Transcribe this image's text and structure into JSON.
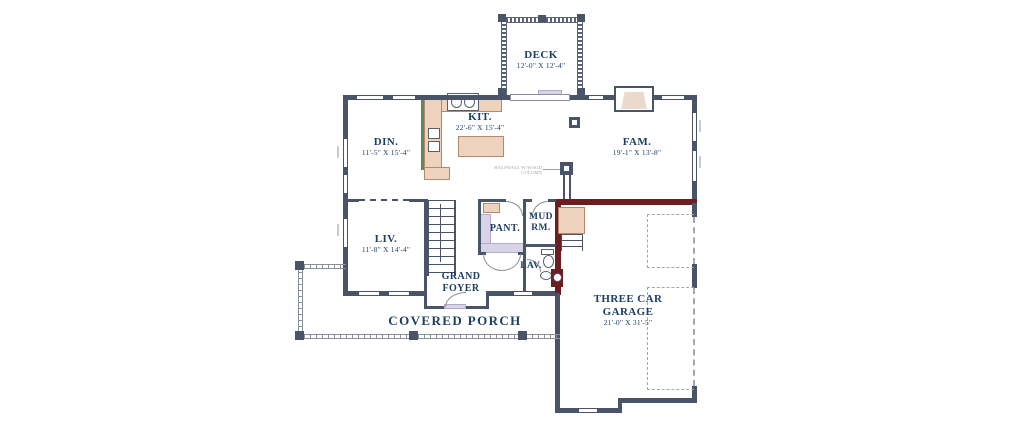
{
  "rooms": {
    "deck": {
      "label": "DECK",
      "dims": "12'-0\" X 12'-4\""
    },
    "dining": {
      "label": "DIN.",
      "dims": "11'-5\" X 15'-4\""
    },
    "kitchen": {
      "label": "KIT.",
      "dims": "22'-6\" X 15'-4\""
    },
    "family": {
      "label": "FAM.",
      "dims": "19'-1\" X 13'-8\""
    },
    "living": {
      "label": "LIV.",
      "dims": "11'-8\" X 14'-4\""
    },
    "pantry": {
      "label": "PANT."
    },
    "mudroom": {
      "label": "MUD RM."
    },
    "lavatory": {
      "label": "LAV."
    },
    "foyer": {
      "label": "GRAND FOYER"
    },
    "porch": {
      "label": "COVERED PORCH"
    },
    "garage": {
      "label": "THREE CAR GARAGE",
      "dims": "21'-0\" X 31'-5\""
    }
  },
  "annotations": {
    "halfwall_note": "HALFWALL W/WOOD COLUMN"
  },
  "colors": {
    "wall": "#4a5468",
    "accent_wall": "#6b1d20",
    "counter_fill": "#edd3bd",
    "counter_border": "#b5886a",
    "cabinet_green": "#5c8a5c",
    "shelf_fill": "#d9d3e8",
    "label_text": "#1d3f63",
    "porch_line": "#8b8f98"
  }
}
